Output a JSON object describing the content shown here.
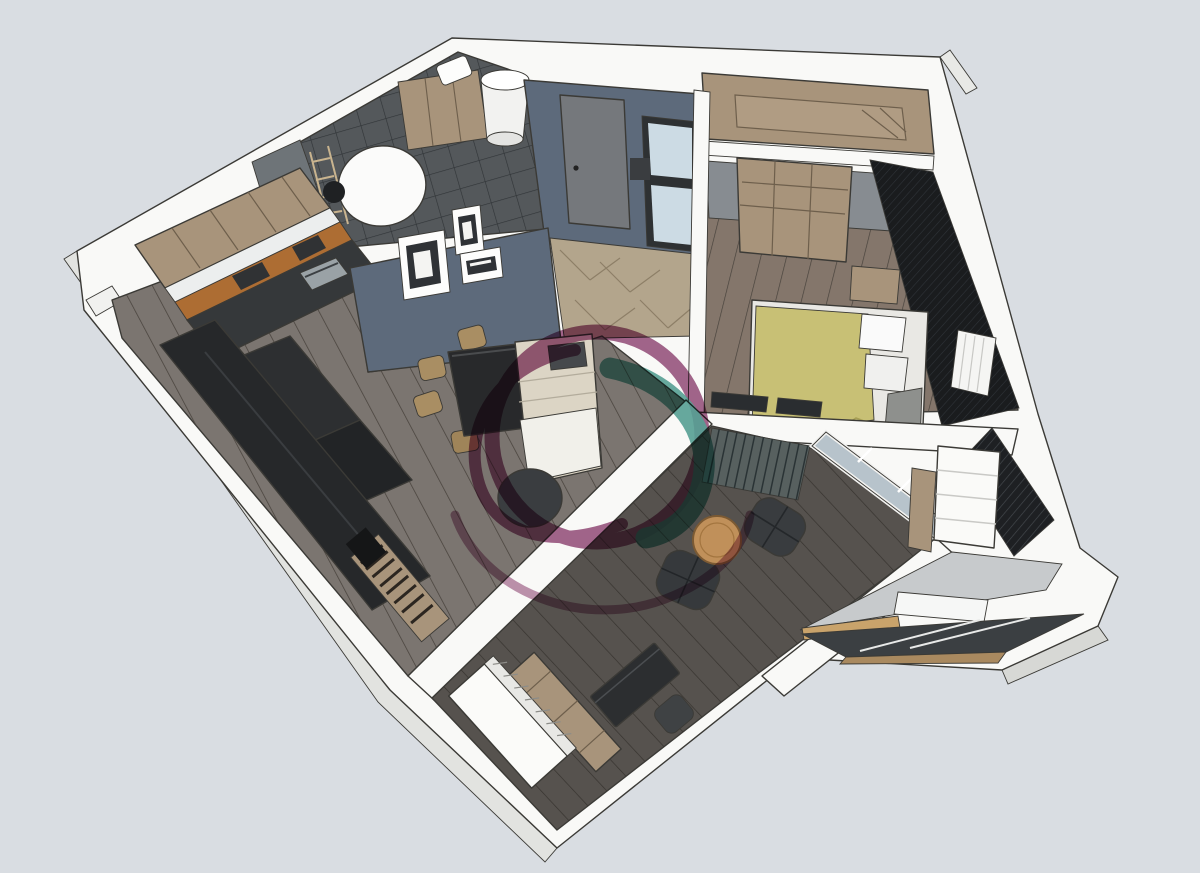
{
  "canvas": {
    "width": 1200,
    "height": 873
  },
  "scene": {
    "type": "3d-floor-plan-render",
    "style": "axonometric-cutaway-apartment",
    "rooms": [
      {
        "name": "bathroom",
        "items": [
          "tiled-walls",
          "round-mirror",
          "water-heater",
          "wood-shelving",
          "ladder-rack",
          "washer-top"
        ]
      },
      {
        "name": "kitchen",
        "items": [
          "upper-cabinets",
          "white-countertop",
          "orange-backsplash",
          "oven",
          "dark-island-counters"
        ]
      },
      {
        "name": "living-room",
        "items": [
          "black-dining-table",
          "wood-chairs",
          "cream-sofa",
          "round-coffee-table",
          "tv-cabinet-band",
          "bookshelf",
          "gallery-frames"
        ]
      },
      {
        "name": "hallway",
        "items": [
          "blue-wall",
          "interior-door",
          "glass-partition",
          "herringbone-floor"
        ]
      },
      {
        "name": "walk-in-closet",
        "items": [
          "wardrobe-top-view"
        ]
      },
      {
        "name": "bedroom",
        "items": [
          "double-bed",
          "yellow-blanket",
          "pillows",
          "open-wardrobe",
          "nightstand",
          "radiator",
          "dark-accent-wall"
        ]
      },
      {
        "name": "lounge-loggia",
        "items": [
          "slatted-accent-wall",
          "window-wall",
          "armchair",
          "armchair",
          "round-wood-table"
        ]
      },
      {
        "name": "entry-study",
        "items": [
          "entry-door",
          "wood-console",
          "desk",
          "desk-chair"
        ]
      },
      {
        "name": "enclosed-balcony",
        "items": [
          "white-shelving",
          "wood-panel",
          "desk-counter",
          "glazed-parapet",
          "dark-grate-floor"
        ]
      }
    ]
  },
  "watermark": {
    "shape": "circular-swirl-logo",
    "purple": "#8d4070",
    "teal": "#2e8c7e"
  },
  "palette": {
    "bg": "#d9dde2",
    "wall-white": "#f9f9f7",
    "wall-shade": "#e2e3e0",
    "line": "#3b3a36",
    "blue-wall": "#5d6a7b",
    "tile-dark": "#54585b",
    "tile-line": "#303437",
    "floor-living": "#7b7570",
    "floor-bedroom": "#84766b",
    "floor-dark": "#56524e",
    "seam": "#48423c",
    "herringbone": "#b3a58c",
    "herringbone-line": "#8d7f67",
    "wood-mid": "#a8947b",
    "wood-dark-line": "#6e5f4c",
    "wood-warm": "#c0905a",
    "orange": "#ad6d33",
    "counter-dark": "#35383a",
    "cabinet-black": "#26282a",
    "glass-pane": "#ccdbe4",
    "glass-big": "#b7c3cb",
    "bed-yellow": "#c8c075",
    "pillow-white": "#fafafa",
    "radiator-white": "#f5f5f3",
    "accent-dark": "#1a1c1e",
    "accent-line": "#30343a",
    "slat-base": "#57605f",
    "slat-line": "#2a3335",
    "gray-wall": "#878c91",
    "chair-dark": "#393c3f",
    "table-black": "#28292b",
    "sofa-cream": "#dcd5c5",
    "throw-white": "#f1f0ea",
    "wing-floor": "#c7cacc",
    "balcony-glass": "#3b3f42",
    "balcony-tan": "#a9895f",
    "door-gray": "#75787c",
    "wm-purple": "#8d4070",
    "wm-teal": "#2e8c7e"
  }
}
